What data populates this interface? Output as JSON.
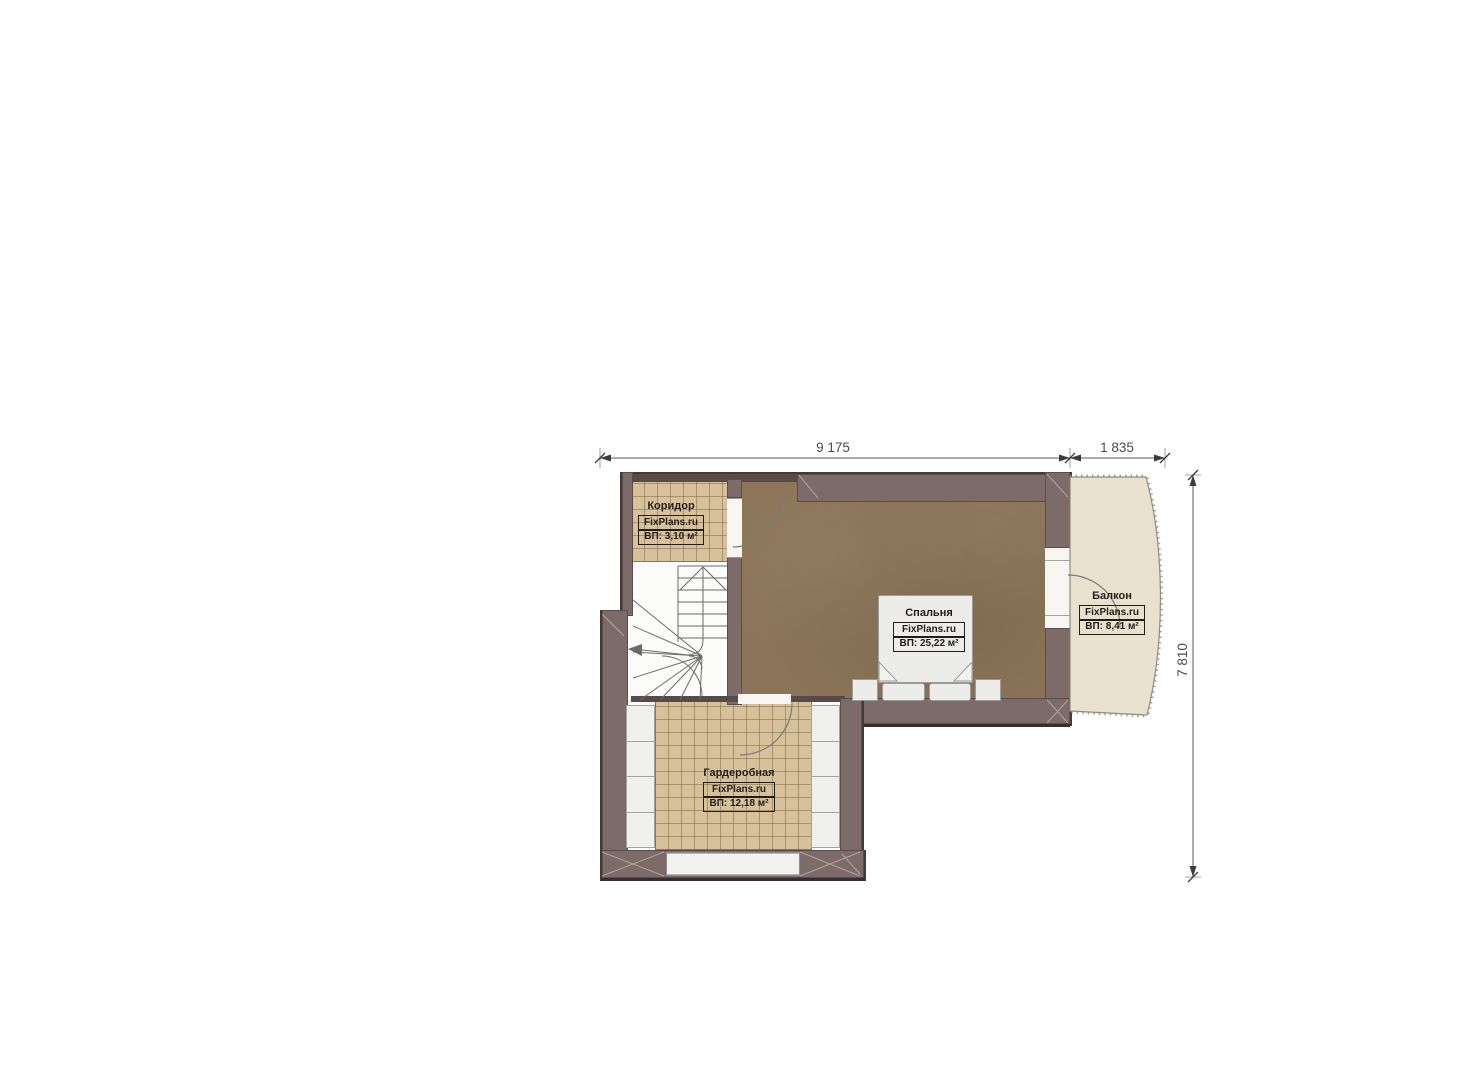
{
  "plan": {
    "title": "floor plan",
    "dimensions": {
      "top_main": "9 175",
      "top_right": "1 835",
      "right_side": "7 810"
    },
    "rooms": [
      {
        "id": "corridor",
        "name": "Коридор",
        "brand": "FixPlans.ru",
        "area": "ВП: 3,10 м²"
      },
      {
        "id": "bedroom",
        "name": "Спальня",
        "brand": "FixPlans.ru",
        "area": "ВП: 25,22 м²"
      },
      {
        "id": "balcony",
        "name": "Балкон",
        "brand": "FixPlans.ru",
        "area": "ВП: 8,41 м²"
      },
      {
        "id": "wardrobe",
        "name": "Гардеробная",
        "brand": "FixPlans.ru",
        "area": "ВП: 12,18 м²"
      }
    ],
    "colors": {
      "wall": "#7c6b68",
      "wall_edge": "#372e2f",
      "bedroom_floor": "#8b7457",
      "tile_floor": "#d7c19b",
      "balcony_floor": "#e9e0cd",
      "furniture": "#ececea",
      "label_text": "#231d18",
      "dimension_text": "#4b4b4b"
    }
  }
}
